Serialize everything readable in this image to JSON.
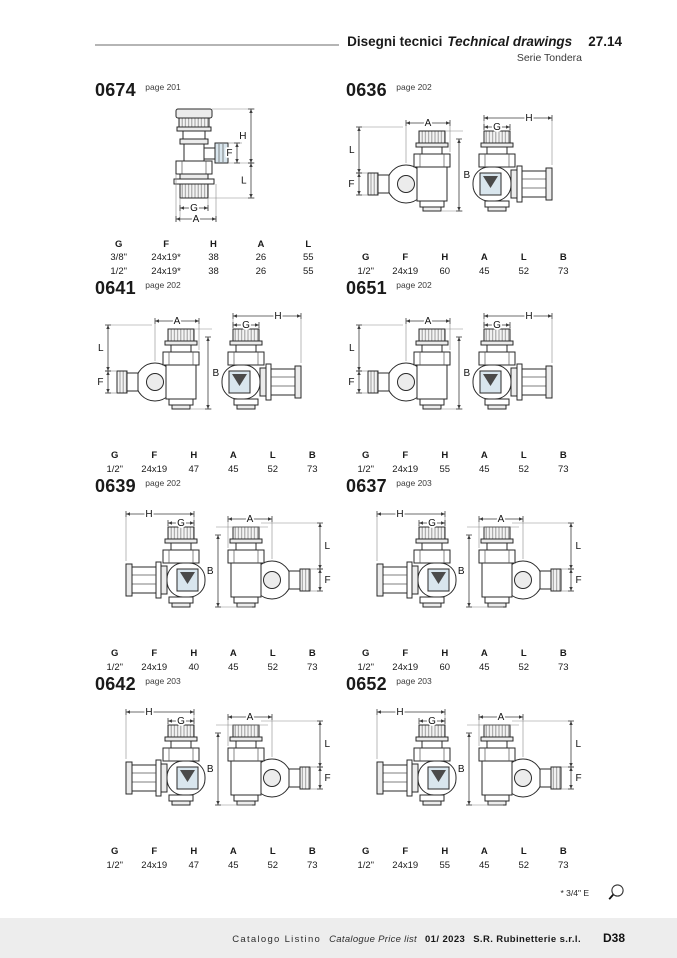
{
  "header": {
    "title_it": "Disegni tecnici",
    "title_en": "Technical drawings",
    "section_no": "27.14",
    "series": "Serie Tondera"
  },
  "sections": [
    {
      "code": "0674",
      "page_ref": "page 201",
      "drawing": "vertical",
      "dim_letters": {
        "h": "H",
        "f": "F",
        "l": "L",
        "g": "G",
        "a": "A"
      },
      "table": {
        "columns": [
          "G",
          "F",
          "H",
          "A",
          "L"
        ],
        "rows": [
          [
            "3/8\"",
            "24x19*",
            "38",
            "26",
            "55"
          ],
          [
            "1/2\"",
            "24x19*",
            "38",
            "26",
            "55"
          ]
        ]
      }
    },
    {
      "code": "0636",
      "page_ref": "page 202",
      "drawing": "angleA",
      "dim_letters": {
        "a": "A",
        "l": "L",
        "f": "F",
        "b": "B",
        "g": "G",
        "h": "H"
      },
      "table": {
        "columns": [
          "G",
          "F",
          "H",
          "A",
          "L",
          "B"
        ],
        "rows": [
          [
            "1/2\"",
            "24x19",
            "60",
            "45",
            "52",
            "73"
          ]
        ]
      }
    },
    {
      "code": "0641",
      "page_ref": "page 202",
      "drawing": "angleA",
      "dim_letters": {
        "a": "A",
        "l": "L",
        "f": "F",
        "b": "B",
        "g": "G",
        "h": "H"
      },
      "table": {
        "columns": [
          "G",
          "F",
          "H",
          "A",
          "L",
          "B"
        ],
        "rows": [
          [
            "1/2\"",
            "24x19",
            "47",
            "45",
            "52",
            "73"
          ]
        ]
      }
    },
    {
      "code": "0651",
      "page_ref": "page 202",
      "drawing": "angleA",
      "dim_letters": {
        "a": "A",
        "l": "L",
        "f": "F",
        "b": "B",
        "g": "G",
        "h": "H"
      },
      "table": {
        "columns": [
          "G",
          "F",
          "H",
          "A",
          "L",
          "B"
        ],
        "rows": [
          [
            "1/2\"",
            "24x19",
            "55",
            "45",
            "52",
            "73"
          ]
        ]
      }
    },
    {
      "code": "0639",
      "page_ref": "page 202",
      "drawing": "angleB",
      "dim_letters": {
        "a": "A",
        "l": "L",
        "f": "F",
        "b": "B",
        "g": "G",
        "h": "H"
      },
      "table": {
        "columns": [
          "G",
          "F",
          "H",
          "A",
          "L",
          "B"
        ],
        "rows": [
          [
            "1/2\"",
            "24x19",
            "40",
            "45",
            "52",
            "73"
          ]
        ]
      }
    },
    {
      "code": "0637",
      "page_ref": "page 203",
      "drawing": "angleB",
      "dim_letters": {
        "a": "A",
        "l": "L",
        "f": "F",
        "b": "B",
        "g": "G",
        "h": "H"
      },
      "table": {
        "columns": [
          "G",
          "F",
          "H",
          "A",
          "L",
          "B"
        ],
        "rows": [
          [
            "1/2\"",
            "24x19",
            "60",
            "45",
            "52",
            "73"
          ]
        ]
      }
    },
    {
      "code": "0642",
      "page_ref": "page 203",
      "drawing": "angleB",
      "dim_letters": {
        "a": "A",
        "l": "L",
        "f": "F",
        "b": "B",
        "g": "G",
        "h": "H"
      },
      "table": {
        "columns": [
          "G",
          "F",
          "H",
          "A",
          "L",
          "B"
        ],
        "rows": [
          [
            "1/2\"",
            "24x19",
            "47",
            "45",
            "52",
            "73"
          ]
        ]
      }
    },
    {
      "code": "0652",
      "page_ref": "page 203",
      "drawing": "angleB",
      "dim_letters": {
        "a": "A",
        "l": "L",
        "f": "F",
        "b": "B",
        "g": "G",
        "h": "H"
      },
      "table": {
        "columns": [
          "G",
          "F",
          "H",
          "A",
          "L",
          "B"
        ],
        "rows": [
          [
            "1/2\"",
            "24x19",
            "55",
            "45",
            "52",
            "73"
          ]
        ]
      }
    }
  ],
  "footnote": {
    "note": "* 3/4\" E",
    "icon": "magnifier-icon"
  },
  "footer": {
    "label_it": "Catalogo Listino",
    "label_en": "Catalogue Price list",
    "date": "01/ 2023",
    "company": "S.R. Rubinetterie s.r.l.",
    "page_code": "D38"
  },
  "colors": {
    "valve_section_fill": "#d9e6ee",
    "metal_fill": "#ececec",
    "footer_bar": "#ededed",
    "header_rule": "#b5b5b5"
  }
}
